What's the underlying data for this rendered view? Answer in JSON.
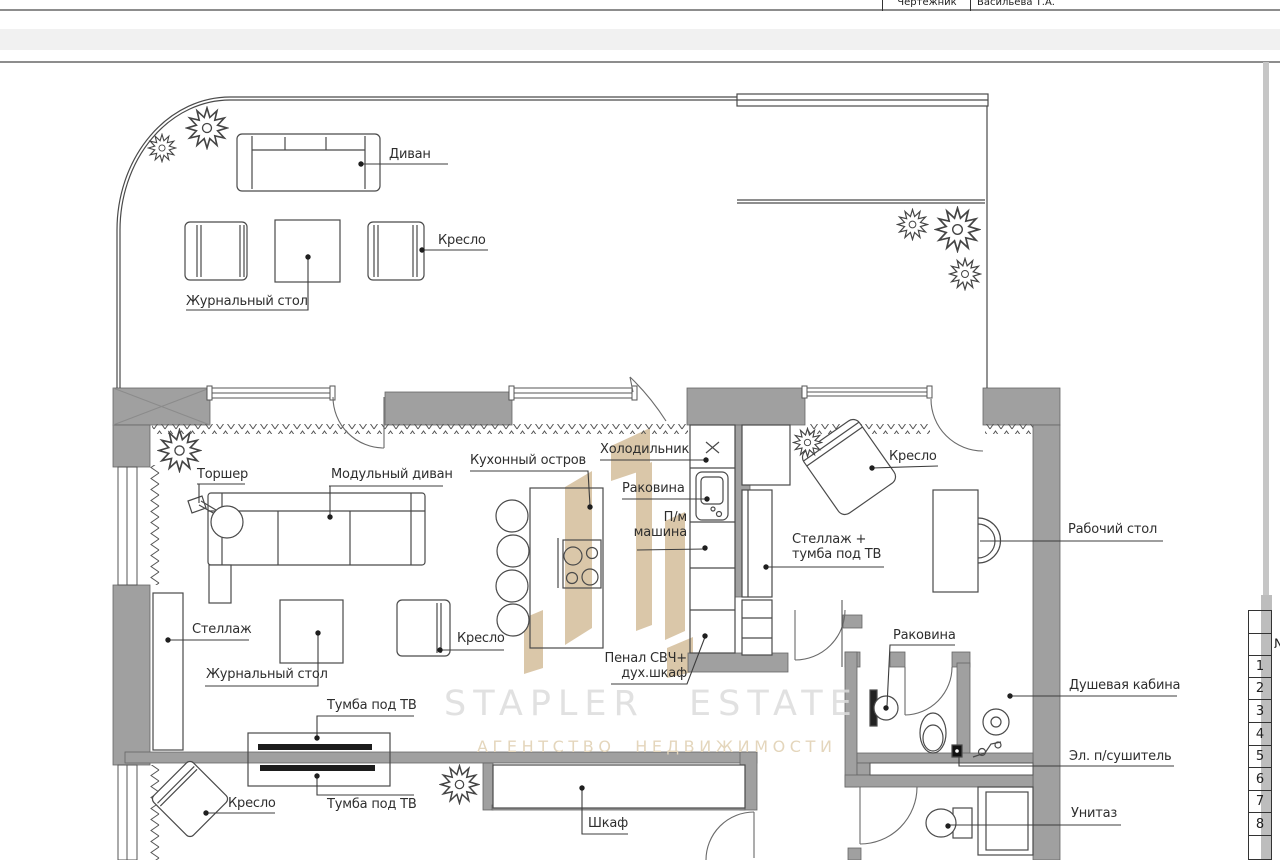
{
  "title_block": {
    "role": "Чертежник",
    "name": "Васильева Т.А."
  },
  "watermark": {
    "brand": "STAPLER ESTATE",
    "tagline": "АГЕНТСТВО НЕДВИЖИМОСТИ"
  },
  "plan": {
    "labels": {
      "divan": "Диван",
      "kreslo_terrace": "Кресло",
      "zhurnalny_stol_terrace": "Журнальный стол",
      "torsher": "Торшер",
      "modulny_divan": "Модульный диван",
      "kuhonny_ostrov": "Кухонный остров",
      "holodilnik": "Холодильник",
      "rakovina_kitchen": "Раковина",
      "pm_mashina_1": "П/м",
      "pm_mashina_2": "машина",
      "penal_1": "Пенал СВЧ+",
      "penal_2": "дух.шкаф",
      "stellazh_tumba_1": "Стеллаж +",
      "stellazh_tumba_2": "тумба под ТВ",
      "kreslo_office": "Кресло",
      "rabochy_stol": "Рабочий стол",
      "stellazh": "Стеллаж",
      "zhurnalny_stol_living": "Журнальный стол",
      "kreslo_living": "Кресло",
      "tumba_tv_upper": "Тумба под ТВ",
      "tumba_tv_lower": "Тумба под ТВ",
      "kreslo_balcony": "Кресло",
      "shkaf": "Шкаф",
      "rakovina_bathroom": "Раковина",
      "dushevaya_kabina": "Душевая кабина",
      "el_sushitel": "Эл. п/сушитель",
      "unitaz": "Унитаз"
    }
  },
  "legend": {
    "header": "№",
    "rows": [
      "1",
      "2",
      "3",
      "4",
      "5",
      "6",
      "7",
      "8"
    ]
  },
  "colors": {
    "wall": "#a0a0a0",
    "line": "#4a4a4a",
    "logo_tan": "#d7c1a0",
    "watermark_text": "#dcdcdc",
    "watermark_tagline": "#e4d6bc"
  }
}
